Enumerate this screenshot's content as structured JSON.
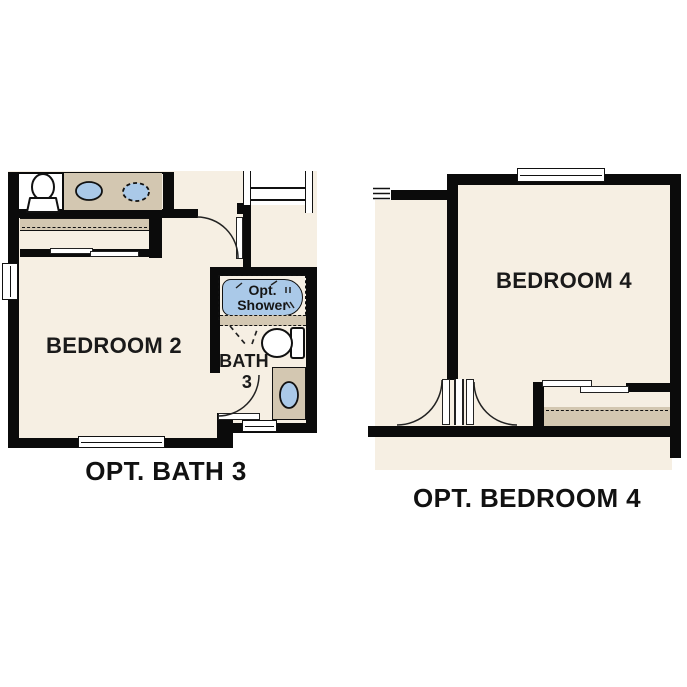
{
  "colors": {
    "wall": "#0b0b0b",
    "floor": "#f6efe3",
    "counter_tan": "#d3c7b1",
    "fixture_blue": "#aac9e8",
    "text": "#1a1a1a"
  },
  "left_plan": {
    "bedroom_label": "BEDROOM 2",
    "bath_label": "BATH",
    "bath_number": "3",
    "shower_line1": "Opt.",
    "shower_line2": "Shower",
    "caption": "OPT. BATH 3"
  },
  "right_plan": {
    "bedroom_label": "BEDROOM 4",
    "caption": "OPT. BEDROOM 4"
  }
}
